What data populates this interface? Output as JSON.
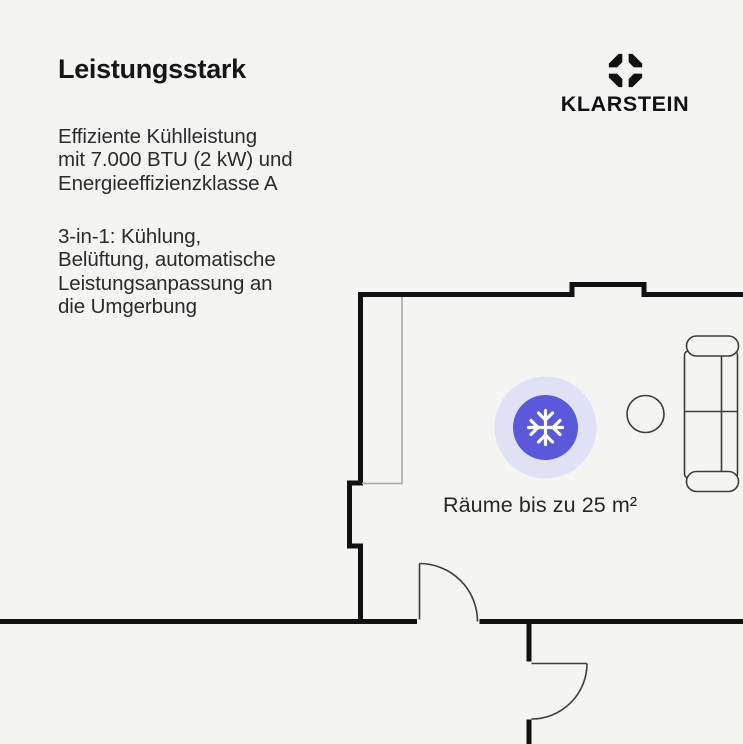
{
  "colors": {
    "background": "#f4f4f3",
    "text": "#2b2b2b",
    "title": "#161616",
    "wall": "#111111",
    "furniture_line": "#3c3c3c",
    "window_line": "#a8a8a8",
    "accent": "#5b58d9",
    "accent_halo": "#e0e1f5",
    "snowflake": "#ffffff",
    "brand": "#111111"
  },
  "intro": {
    "title": "Leistungsstark",
    "paragraph1": {
      "lines": [
        "Effiziente Kühlleistung",
        "mit 7.000 BTU (2 kW) und",
        "Energieeffizienzklasse A"
      ]
    },
    "paragraph2": {
      "lines": [
        "3-in-1: Kühlung,",
        "Belüftung, automatische",
        "Leistungsanpassung an",
        "die Umgerbung"
      ]
    }
  },
  "brand": {
    "name": "KLARSTEIN",
    "logo_icon": "klarstein-diamond-icon"
  },
  "floorplan": {
    "room_label": "Räume bis zu 25 m²",
    "marker_icon": "snowflake-icon",
    "furniture": [
      "window",
      "door",
      "door",
      "sofa",
      "side-table"
    ]
  }
}
